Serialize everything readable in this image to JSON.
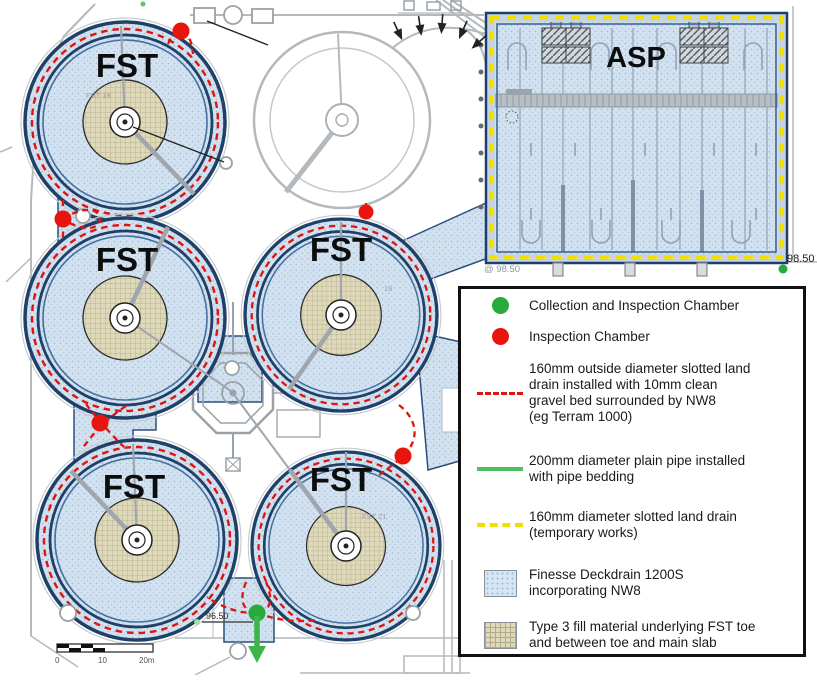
{
  "plan": {
    "fst_label": "FST",
    "asp_label": "ASP",
    "tank_ids": {
      "top_left": "FST 18",
      "mid_right": "19",
      "bottom_right": "FST 21"
    },
    "levels": {
      "asp_bottom_left": "@ 98.50",
      "asp_bottom_right": "98.50",
      "collection_chamber": "96.50"
    },
    "scale_bar": {
      "ticks": [
        "0",
        "10",
        "20m"
      ]
    }
  },
  "legend": {
    "items": [
      {
        "id": "collection-inspection-chamber",
        "swatch": "green-dot",
        "label": "Collection and Inspection Chamber"
      },
      {
        "id": "inspection-chamber",
        "swatch": "red-dot",
        "label": "Inspection Chamber"
      },
      {
        "id": "slotted-land-drain",
        "swatch": "red-dashed-line",
        "label": "160mm outside diameter slotted land\ndrain installed with 10mm clean\ngravel bed surrounded by NW8\n(eg Terram 1000)"
      },
      {
        "id": "plain-pipe",
        "swatch": "green-solid-line",
        "label": "200mm diameter plain pipe installed\nwith pipe bedding"
      },
      {
        "id": "temporary-land-drain",
        "swatch": "yellow-dashed-line",
        "label": "160mm diameter slotted land drain\n(temporary works)"
      },
      {
        "id": "finesse-deckdrain",
        "swatch": "blue-fill",
        "label": "Finesse Deckdrain 1200S\nincorporating NW8"
      },
      {
        "id": "type3-fill",
        "swatch": "tan-fill",
        "label": "Type 3 fill material underlying FST toe\nand between toe and main slab"
      }
    ]
  },
  "colors": {
    "drain_red": "#e0140e",
    "pipe_green": "#3db54a",
    "temporary_yellow": "#f0e000",
    "deckdrain_blue": "#d6e5f3",
    "type3_tan": "#ded9ba",
    "tank_ring_navy": "#1f4067"
  }
}
